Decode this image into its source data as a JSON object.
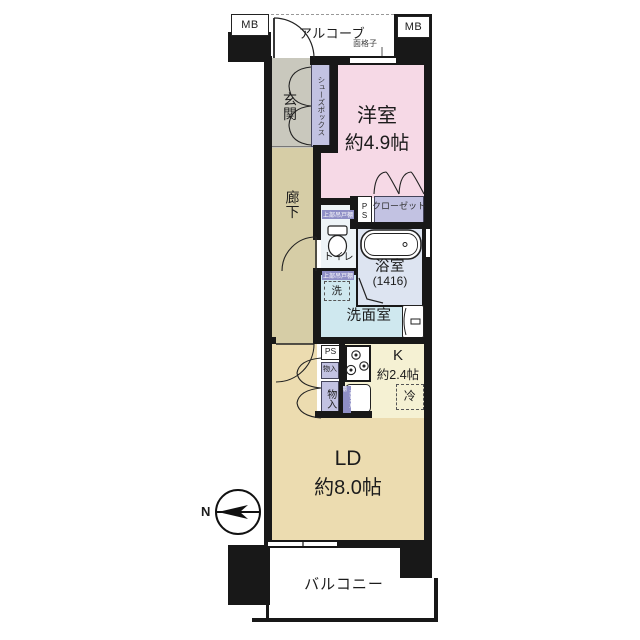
{
  "labels": {
    "mb_left": "MB",
    "mb_right": "MB",
    "alcove": "アルコーブ",
    "window_grille": "面格子",
    "entrance": "玄関",
    "shoe_box": "シューズボックス",
    "corridor": "廊下",
    "pipe_space_upper": "PS",
    "closet": "クローゼット",
    "upper_cabinet_toilet": "上部吊戸棚",
    "toilet": "トイレ",
    "upper_cabinet_washer": "上部吊戸棚",
    "washer": "洗",
    "washroom": "洗面室",
    "pipe_space_kitchen": "PS",
    "storage_small": "物入",
    "storage_large": "物入",
    "upper_cabinet_kitchen": "上部吊戸棚",
    "fridge": "冷",
    "balcony": "バルコニー",
    "compass_north": "N"
  },
  "rooms": {
    "western": {
      "name": "洋室",
      "size": "約4.9帖"
    },
    "kitchen": {
      "name": "K",
      "size": "約2.4帖"
    },
    "living_dining": {
      "name": "LD",
      "size": "約8.0帖"
    },
    "bath": {
      "name": "浴室",
      "size": "(1416)"
    }
  },
  "colors": {
    "wall": "#181818",
    "western_room": "#f6d9e6",
    "corridor": "#d6cda6",
    "living_dining": "#ecdcb0",
    "kitchen": "#f5f1d3",
    "washroom": "#cfe8ef",
    "bath": "#dde4f1",
    "toilet_room": "#eef4f7",
    "entrance_hall": "#c9c8bd",
    "storage": "#c2c2e2",
    "cabinet_label": "#8f8fc6"
  }
}
